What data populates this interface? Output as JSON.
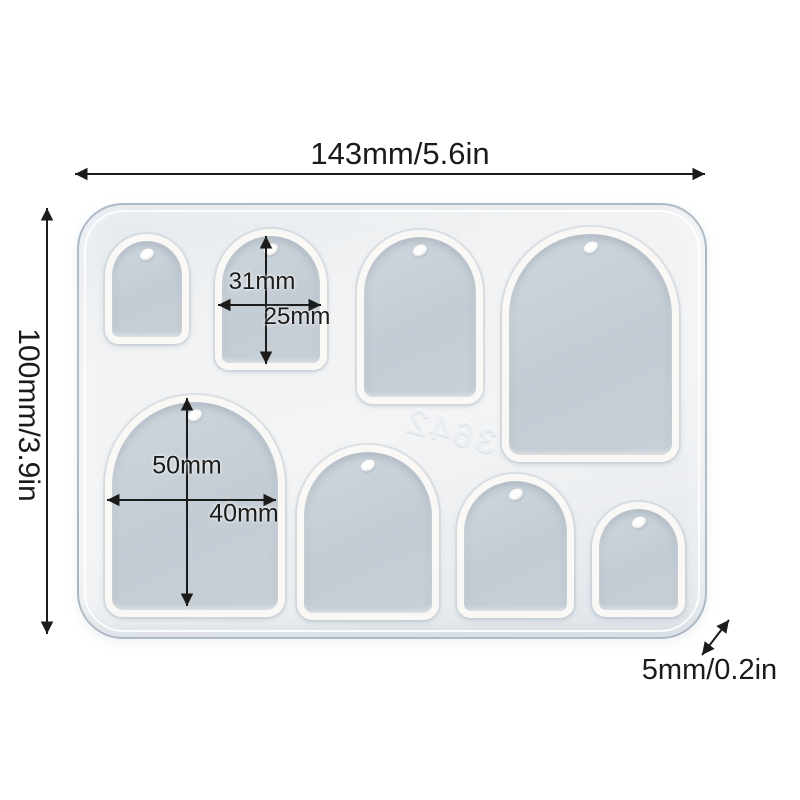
{
  "page": {
    "background_color": "#ffffff"
  },
  "product": {
    "name": "arch-pendant-silicone-resin-mold",
    "cavity_count": 8,
    "marking": "3642",
    "colors": {
      "mold_body": "#eff1f3",
      "mold_rim": "#98aaba",
      "cavity_interior": "#c6ced6",
      "cavity_wall": "#f9f8f4",
      "annotation_ink": "#1b1b1b"
    }
  },
  "dimensions": {
    "overall_width": "143mm/5.6in",
    "overall_height": "100mm/3.9in",
    "thickness": "5mm/0.2in",
    "small_cavity_height": "31mm",
    "small_cavity_width": "25mm",
    "large_cavity_height": "50mm",
    "large_cavity_width": "40mm"
  }
}
